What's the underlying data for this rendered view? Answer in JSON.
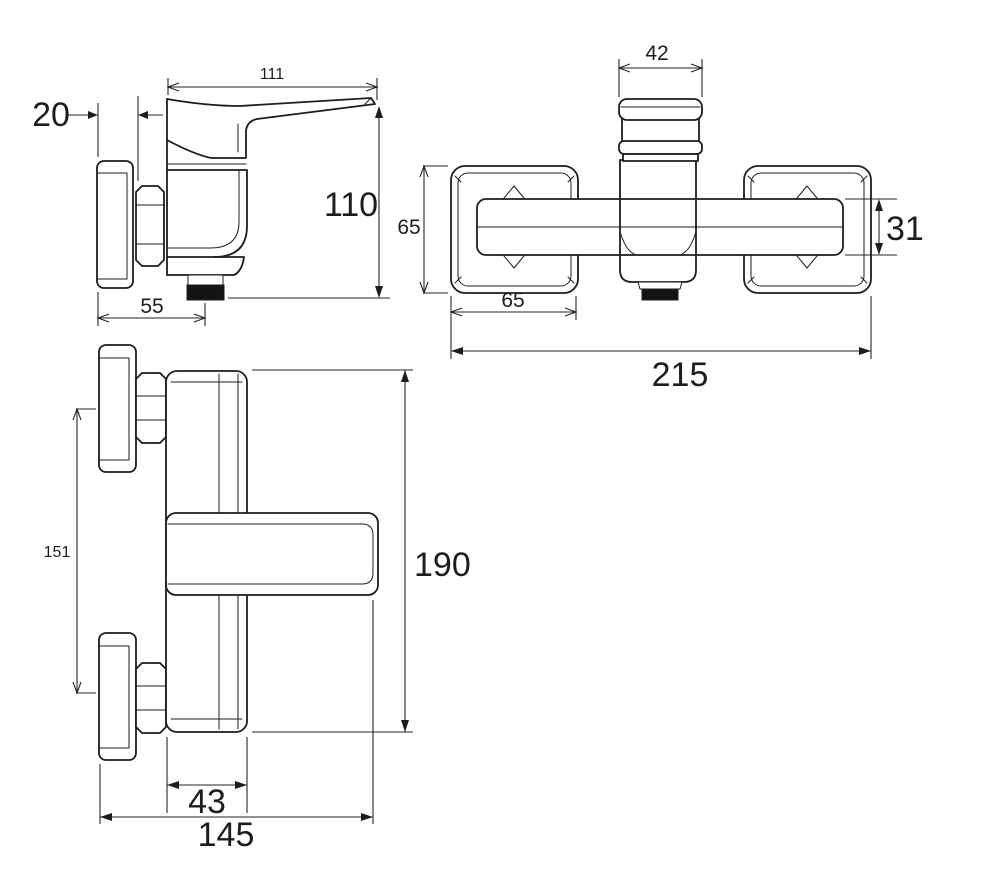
{
  "drawing": {
    "colors": {
      "line": "#1d1d1b",
      "dimension": "#262626",
      "aerator_fill": "#141414",
      "background": "#ffffff"
    },
    "views": [
      {
        "id": "side-view-spout",
        "position": "top-left",
        "dimensions": [
          "111",
          "20",
          "110",
          "55"
        ]
      },
      {
        "id": "front-view",
        "position": "top-right",
        "dimensions": [
          "42",
          "65",
          "31",
          "65",
          "215"
        ]
      },
      {
        "id": "side-view-mounted",
        "position": "bottom-left",
        "dimensions": [
          "151",
          "190",
          "43",
          "145"
        ]
      }
    ],
    "dims": {
      "d111": "111",
      "d20": "20",
      "d110": "110",
      "d55": "55",
      "d42": "42",
      "d65v": "65",
      "d65h": "65",
      "d31": "31",
      "d215": "215",
      "d151": "151",
      "d190": "190",
      "d43": "43",
      "d145": "145"
    }
  }
}
